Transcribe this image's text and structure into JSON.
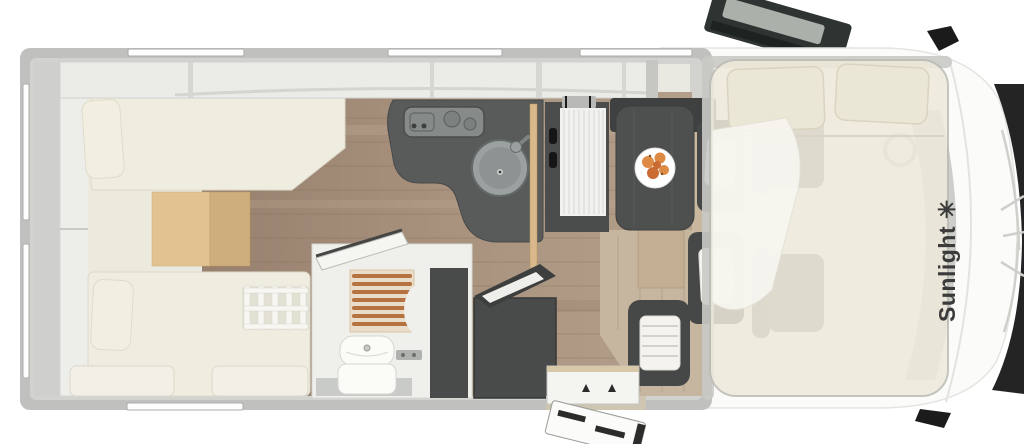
{
  "scene": {
    "type": "motorhome-floorplan-top-view",
    "brand": {
      "label": "Sunlight",
      "logo_glyph": "✳"
    }
  },
  "colors": {
    "background": "#ffffff",
    "wall": "#c0c0be",
    "wall_mid": "#d2d2cf",
    "interior": "#eae9e1",
    "cabinet": "#ebebe8",
    "cabinet_divider": "#d6d6d2",
    "left_column": "#cfcfcd",
    "door_panel": "#ededea",
    "bed_cream": "#efede0",
    "pillow": "#f2efe2",
    "cushion": "#f1efe6",
    "ladder_white": "#f7f6f2",
    "step_wood": "#e2c291",
    "step_wood_dark": "#cfae7e",
    "floor_wood": "#a38d79",
    "floor_wood_light": "#c6b59f",
    "counter_dark": "#595b5a",
    "stove_gray": "#868b8a",
    "sink_gray": "#9ba1a0",
    "sink_inner": "#8c9392",
    "partition_wood": "#d9b88c",
    "fridge_dark": "#4b4d4c",
    "fridge_panel": "#f1f1ef",
    "seat_dark": "#454846",
    "seat_back": "#3e413f",
    "headrest_white": "#f4f3ef",
    "table_dark": "#4d504e",
    "pedestal_wood": "#c3ad93",
    "plate_white": "#ffffff",
    "food_orange": "#dd8a45",
    "food_orange_dark": "#c96b33",
    "bathroom_white": "#efefeb",
    "shower_base": "#e9dcc8",
    "shower_slat": "#b5713f",
    "toilet_white": "#fbfbf8",
    "wardrobe_dark": "#494b4a",
    "overlay_bed": "#eeeadb",
    "overlay_frame": "#c9c9c5",
    "duvet_white": "#f7f6f0",
    "window_pane": "#aab1ab",
    "door_dark": "#2e3432",
    "grille_dark": "#242424",
    "cab_white": "#fbfbf9",
    "window_strip": "#fdfdfd",
    "brand_text": "#3b3b3b"
  }
}
